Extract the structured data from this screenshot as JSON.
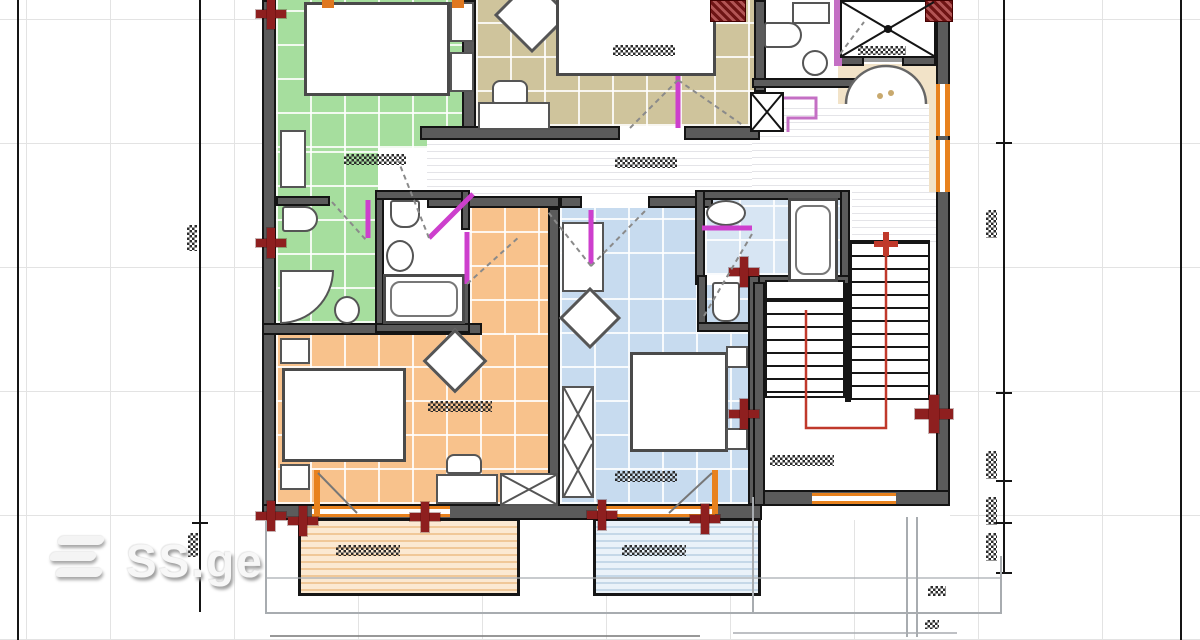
{
  "watermark": {
    "brand": "SS.ge",
    "icon": "ssge-bars-icon"
  },
  "colors": {
    "wall": "#5b5b5b",
    "edge": "#141414",
    "green": "#a6de9e",
    "tan": "#cfc49c",
    "orange": "#f8c28c",
    "blue": "#c7dbef",
    "bluelight": "#d7e5f3",
    "magenta": "#cd3fcd",
    "magentawall": "#c46fc4",
    "winorange": "#e8821e",
    "markerred": "#8e1f1f",
    "stairred": "#c0392b",
    "cream": "#f2e3c8",
    "grid": "#e3e3e3",
    "dim": "#151515",
    "balcorange": "#f0c898",
    "balcblue": "#c5d8e8"
  },
  "plan": {
    "type": "apartment-floor-plan",
    "rooms": [
      {
        "name": "bedroom-green",
        "floor": "green tiles"
      },
      {
        "name": "bedroom-tan",
        "floor": "tan tiles"
      },
      {
        "name": "bedroom-orange",
        "floor": "orange tiles"
      },
      {
        "name": "bedroom-blue",
        "floor": "blue tiles"
      },
      {
        "name": "hallway",
        "floor": "striped"
      },
      {
        "name": "bathroom-ensuite",
        "floor": "green tiles"
      },
      {
        "name": "bathroom-middle",
        "floor": "white"
      },
      {
        "name": "bathroom-blue",
        "floor": "light-blue tiles"
      },
      {
        "name": "wc",
        "floor": "white"
      },
      {
        "name": "elevator-shaft",
        "symbol": "crossed-box"
      },
      {
        "name": "staircase",
        "symbol": "treads with red travel path"
      },
      {
        "name": "entry-landing",
        "floor": "cream"
      },
      {
        "name": "balcony-left",
        "floor": "striped orange"
      },
      {
        "name": "balcony-right",
        "floor": "striped blue"
      }
    ],
    "furniture": [
      "double-bed",
      "nightstand",
      "wardrobe-crossed",
      "desk",
      "chair",
      "ottoman-diamond",
      "cabinet"
    ],
    "fixtures": [
      "bathtub",
      "corner-shower",
      "toilet",
      "sink"
    ],
    "annotations": {
      "dimension_marks": "illegible checkered numerals",
      "door_swings": "magenta leaves with dashed arcs",
      "stair_path": "red line with cross arrow",
      "anchor_markers": "dark red crosses",
      "windows": "orange double lines"
    }
  }
}
